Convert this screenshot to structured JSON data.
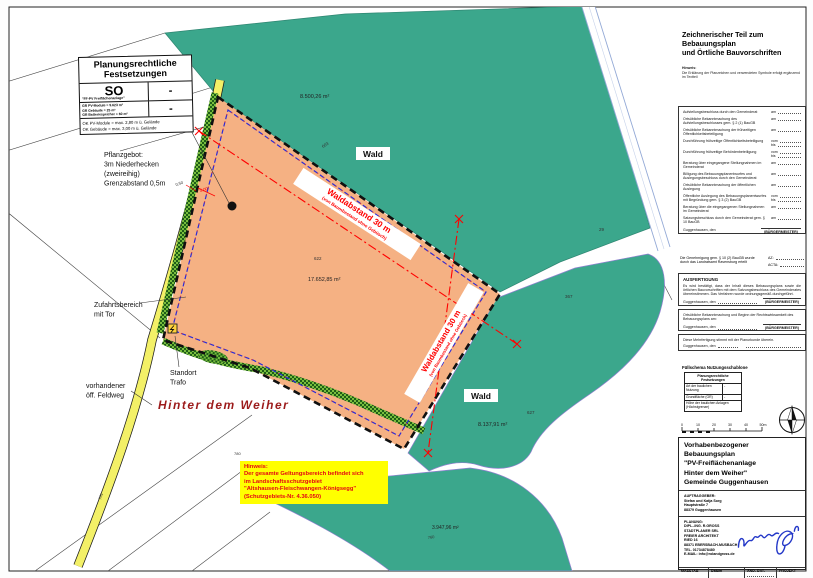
{
  "legend_box": {
    "title_line1": "Planungsrechtliche",
    "title_line2": "Festsetzungen",
    "so_code": "SO",
    "so_footnote": "\"FF-PV Freiflächenanlage\"",
    "so_value": "-",
    "gr_lines": [
      "GR PV-Module = 9.623 m²",
      "GR Gebäude = 25 m²",
      "GR Batteriespeicher = 60 m²"
    ],
    "gr_value": "-",
    "ok_lines": [
      "OK PV-Module  = max. 2,80 m ü. Gelände",
      "OK Gebäude    = max. 3,00 m ü. Gelände"
    ]
  },
  "map": {
    "street_name": "Hinter dem Weiher",
    "wald_label": "Wald",
    "waldabstand_line1": "Waldabstand 30 m",
    "waldabstand_line2": "(von Baumbestand ohne Gebüsch)",
    "areas": {
      "north_forest": "8.500,26 m²",
      "plan_area": "17.652,85 m²",
      "east_forest": "8.137,91 m²",
      "south_forest": "3.947,96 m²"
    },
    "parcels": {
      "p603": "603",
      "p622": "622",
      "p627": "627",
      "p367": "367",
      "p29": "29",
      "p760": "760",
      "p780": "780",
      "p761": "761"
    },
    "dims": {
      "d050": "0,50",
      "d500": "5,00"
    },
    "labels": {
      "pflanzgebot": [
        "Pflanzgebot:",
        "3m Niederhecken",
        "(zweireihig)",
        "Grenzabstand 0,5m"
      ],
      "zufahrt": [
        "Zufahrtsbereich",
        "mit Tor"
      ],
      "standort": [
        "Standort",
        "Trafo"
      ],
      "feldweg": [
        "vorhandener",
        "öff. Feldweg"
      ]
    },
    "note_lines": [
      "Hinweis:",
      "Der gesamte Geltungsbereich befindet sich",
      "im Landschaftsschutzgebiet",
      "\"Altshausen-Fleischwangen-Königsegg\"",
      "(Schutzgebiets-Nr. 4.36.050)"
    ]
  },
  "right_panel": {
    "header_line1": "Zeichnerischer Teil zum Bebauungsplan",
    "header_line2": "und Örtliche Bauvorschriften",
    "note_label": "Hinweis:",
    "note_text": "Die Erklärung der Planzeichen und verwendeten Symbole erfolgt ergänzend im Textteil",
    "procedure_rows": [
      {
        "label": "Aufstellungsbeschluss durch den Gemeinderat",
        "value": "am"
      },
      {
        "label": "Ortsübliche Bekanntmachung des Aufstellungsbeschlusses gem. § 2 (1) BauGB",
        "value": "am"
      },
      {
        "label": "Ortsübliche Bekanntmachung der frühzeitigen Öffentlichkeitsbeteiligung",
        "value": "am"
      },
      {
        "label": "Durchführung frühzeitige Öffentlichkeitsbeteiligung",
        "value": "vom",
        "value2": "bis"
      },
      {
        "label": "Durchführung frühzeitige Behördenbeteiligung",
        "value": "vom",
        "value2": "bis"
      },
      {
        "label": "Beratung über eingegangene Stellungnahmen im Gemeinderat",
        "value": "am"
      },
      {
        "label": "Billigung des Bebauungsplanentwurfes und Auslegungsbeschluss durch den Gemeinderat",
        "value": "am"
      },
      {
        "label": "Ortsübliche Bekanntmachung der öffentlichen Auslegung",
        "value": "am"
      },
      {
        "label": "Öffentliche Auslegung des Bebauungsplanentwurfes mit Begründung gem. § 3 (2) BauGB",
        "value": "vom",
        "value2": "bis"
      },
      {
        "label": "Beratung über die eingegangenen Stellungnahmen im Gemeinderat",
        "value": "am"
      },
      {
        "label": "Satzungsbeschluss durch den Gemeinderat gem. § 10 BauGB",
        "value": "am"
      },
      {
        "label": "Guggenhausen, den",
        "value": "(BÜRGERMEISTER)"
      }
    ],
    "approval": {
      "text": "Die Genehmigung gem. § 10 (2) BauGB wurde durch das Landratsamt Ravensburg erteilt",
      "az": "AZ:",
      "acta": "ACTA:"
    },
    "ausfertigung": {
      "title": "AUSFERTIGUNG",
      "body": "Es wird bestätigt, dass der Inhalt dieses Bebauungsplans sowie die örtlichen Bauvorschriften mit dem Satzungsbeschluss des Gemeinderates übereinstimmen. Das Verfahren wurde ordnungsgemäß durchgeführt.",
      "signoff": "Guggenhausen, den",
      "mayor": "(BÜRGERMEISTER)"
    },
    "bekanntmachung": {
      "body": "Ortsübliche Bekanntmachung und Beginn der Rechtswirksamkeit des Bebauungsplans am:",
      "signoff": "Guggenhausen, den",
      "mayor": "(BÜRGERMEISTER)"
    },
    "mehrfertigung": {
      "body": "Diese Mehrfertigung stimmt mit der Planurkunde überein.",
      "signoff": "Guggenhausen, den"
    },
    "fuellschema": {
      "title": "Füllschema Nutzungsschablone",
      "header_line1": "Planungsrechtliche",
      "header_line2": "Festsetzungen",
      "row1_label": "Art der baulichen Nutzung",
      "row1_value": "-",
      "row2_label": "Grundfläche (GR)",
      "row2_value": "-",
      "footer": "Höhe der baulichen Anlagen (Höchstgrenze)"
    },
    "scale_ticks": [
      "0",
      "10",
      "20",
      "30",
      "40",
      "50m"
    ]
  },
  "title_block": {
    "title_lines": [
      "Vorhabenbezogener Bebauungsplan",
      "\"PV-Freiflächenanlage",
      "Hinter dem Weiher\"",
      "Gemeinde Guggenhausen"
    ],
    "client_label": "AUFTRAGGEBER:",
    "client_lines": [
      "Stefan und Katja Sorg",
      "Hauptstraße 7",
      "88379 Guggenhausen"
    ],
    "planner_label": "PLANUNG:",
    "planner_lines": [
      "DIPL.-ING. R.GROSS",
      "STADTPLANER SRL",
      "FREIER ARCHITEKT",
      "RIED 16",
      "88371 EBERSBACH-MUSBACH",
      "TEL. 01734878480",
      "E-MAIL: info@rolandgross.de"
    ],
    "table": {
      "col1_label": "MASSTAB",
      "col2_label": "Datum",
      "col3_label": "ÄND.-DAT.",
      "col4_label": "PROJEKT",
      "col1_value": "1: 500",
      "col2_value": "16.04.2024",
      "col3_value": "10.11.2025",
      "col4_value": "P 37-01"
    }
  },
  "colors": {
    "forest_teal": "#3BA78C",
    "plan_orange": "#F5B183",
    "path_yellow": "#F3F067",
    "hedge_green": "#79BD3E",
    "boundary_black": "#101010",
    "baugrenze_blue": "#2B2BD8",
    "wald_red": "#FF0000",
    "street_maroon": "#9C1B1B",
    "notice_yellow": "#FFFF00",
    "signature_blue": "#2438C8"
  }
}
